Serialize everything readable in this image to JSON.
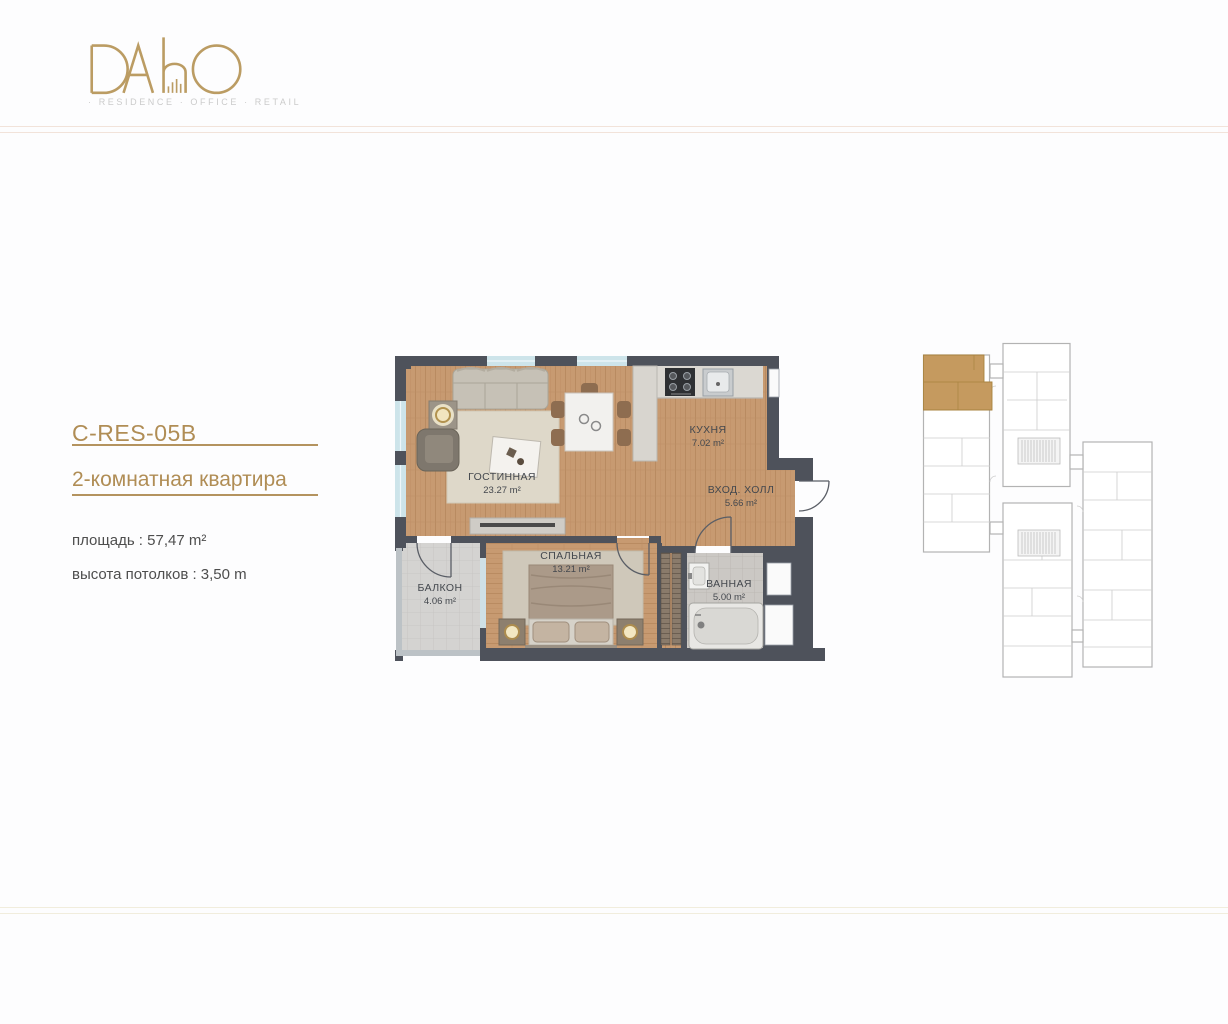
{
  "header": {
    "logo": "DAhO",
    "tagline": "· RESIDENCE · OFFICE · RETAIL"
  },
  "unit_info": {
    "code": "C-RES-05B",
    "title": "2-комнатная квартира",
    "area": "площадь : 57,47 m²",
    "ceiling": "высота потолков : 3,50 m"
  },
  "floorplan": {
    "rooms": {
      "living": {
        "name": "ГОСТИННАЯ",
        "area": "23.27 m²"
      },
      "kitchen": {
        "name": "КУХНЯ",
        "area": "7.02 m²"
      },
      "hall": {
        "name": "ВХОД. ХОЛЛ",
        "area": "5.66 m²"
      },
      "bedroom": {
        "name": "СПАЛЬНАЯ",
        "area": "13.21 m²"
      },
      "balcony": {
        "name": "БАЛКОН",
        "area": "4.06 m²"
      },
      "bath": {
        "name": "ВАННАЯ",
        "area": "5.00 m²"
      }
    }
  },
  "colors": {
    "accent_gold": "#b08d55",
    "logo_gold": "#bb9c63",
    "wall": "#4e525b",
    "wood_floor": "#c79a71",
    "keyplan_highlight": "#c59a5f",
    "window_glass": "#cde4ea"
  }
}
